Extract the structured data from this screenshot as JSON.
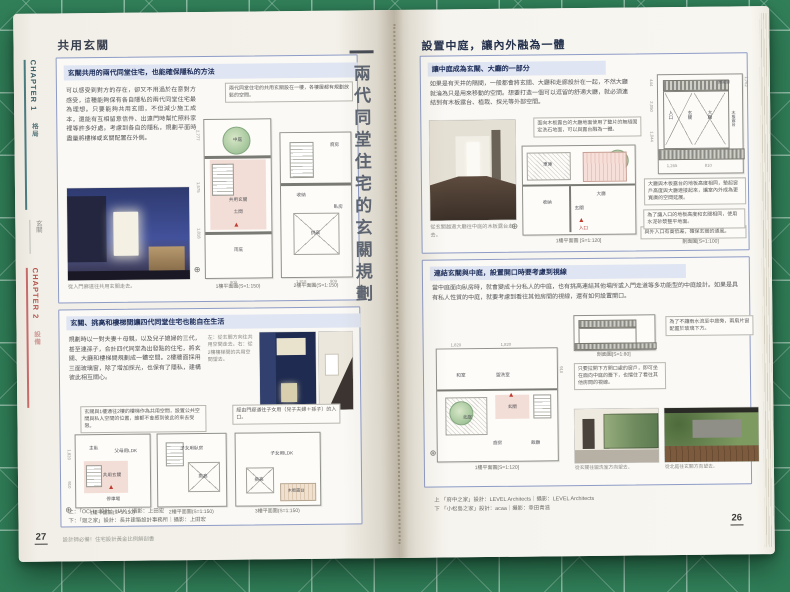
{
  "icons": {
    "compass": "⊕"
  },
  "spine": {
    "title": "兩代同堂住宅的玄關規劃"
  },
  "left_page": {
    "tabs": {
      "chapter1": "CHAPTER 1",
      "chapter1_topic": "格局",
      "chapter1_sub": "玄關",
      "chapter2": "CHAPTER 2",
      "chapter2_topic": "設備"
    },
    "header": "共用玄關",
    "section1": {
      "title": "玄關共用的兩代同堂住宅，也能確保隱私的方法",
      "body": "可以感受到對方的存在，卻又不用過於在意對方感受，這種能夠保有各自隱私的兩代同堂住宅最為理想。只要能夠共用玄關，不但減少施工成本，還能有互相留意信件、出遠門時幫忙照料家裡等許多好處。考慮到各自的隱私，規劃平面時盡量將樓梯或玄關配置在外側。",
      "callout": "兩代同堂住宅的共用玄關設在一樓，各樓層都有規劃放鬆的空間。",
      "photo_caption": "從入門廊道往共用玄關走去。",
      "plan1": {
        "label": "1樓平面圖(S=1:150)",
        "rooms": [
          "中庭",
          "共用玄關",
          "土間",
          "雨庇"
        ],
        "dims": [
          "2,777",
          "1,575",
          "1,818",
          "909"
        ]
      },
      "plan2": {
        "label": "2樓平面圖(S=1:150)",
        "rooms": [
          "廚房",
          "收納",
          "挑高",
          "臥房"
        ],
        "dims": [
          "1,818",
          "909"
        ]
      }
    },
    "section2": {
      "title": "玄關、挑高和樓梯間讓四代同堂住宅也能自在生活",
      "body": "規劃時以一對夫妻＋母親，以及兒子媳婦的三代，甚至連孫子，合計四代同堂為出發點的住宅，將玄關、大廳和樓梯間規劃成一體空間。2樓牆面採用三面玻璃窗，除了增加採光，也保有了隱私，建構彼此相互關心。",
      "caption": "左：從玄關方向往共用空間走去。右：從2樓樓梯間的共用空間望去。",
      "callout1": "玄關與1樓通往2樓的樓梯作為共用空間，設置公共空間與私人空間的位置，誰都不會感到彼此的來去受限。",
      "callout2": "經由門廊通往子女用（兒子夫婦＋孫子）的入口。",
      "plan1": {
        "label": "1樓平面圖(S=1:150)",
        "rooms": [
          "共用玄關",
          "主臥",
          "父母用LDK",
          "停車場"
        ],
        "dims": [
          "1,820",
          "910"
        ]
      },
      "plan2": {
        "label": "2樓平面圖(S=1:150)",
        "rooms": [
          "子女用臥房",
          "挑高"
        ]
      },
      "plan3": {
        "label": "3樓平面圖(S=1:150)",
        "rooms": [
          "子女用LDK",
          "挑高",
          "木板露台"
        ]
      }
    },
    "credits": [
      "上：「OCH」設計：HAK｜攝影：上田宏",
      "下：「廻之家」設計：長井建築設計事務所｜攝影：上田宏"
    ],
    "footer": {
      "page_number": "27",
      "book_title": "設計師必備！住宅設計黃金比例解剖書"
    }
  },
  "right_page": {
    "header": "設置中庭，讓內外融為一體",
    "section1": {
      "title": "讓中庭成為玄關、大廳的一部分",
      "body": "如果是有天井的隔間，一般都會將玄關、大廳和走廊設計在一起，不然大廳就淪為只是用來移動的空間。想要打造一個可以逗留的舒適大廳，就必須連結到有木板露台、植栽、採光等外部空間。",
      "plan_callout": "面向木板露台的大廳地面使用了整片的無縫固定洗石地面，可以與露台融為一體。",
      "photo_caption": "從玄關越過大廳往中庭的木板露台走去。",
      "plan": {
        "label": "1樓平面圖 [S=1:120]",
        "rooms": [
          "車庫",
          "大廳",
          "收納",
          "玄關",
          "入口"
        ]
      },
      "plan_note": "與外入口有高低差，確保玄關的通風。",
      "section_drawing": {
        "label": "剖面圖[S=1:100]",
        "rooms": [
          "入口",
          "玄關",
          "大廳",
          "木板露台",
          "固定窗"
        ],
        "dims": [
          "1,762",
          "444",
          "2,050",
          "1,044",
          "1,265",
          "810"
        ]
      },
      "section_callout1": "大廳與木板露台的地板高度相同，墊起窗戶高度與大廳連接起來，讓室內外成為更寬廣的空間延展。",
      "section_callout2": "為了讓入口的地板高度和玄關相同，使用水泥砂漿整平地面。"
    },
    "section2": {
      "title": "連結玄關與中庭，設置開口時要考慮到視線",
      "body": "當中庭面向臥房時，就會變成十分私人的中庭，也有挑高連結其他場所或入門走道等多功能型的中庭設計。如果是具有私人性質的中庭，就要考慮到看往其他房間的視線，還有如何設置開口。",
      "callout1": "為了不讓雨水流至中庭旁，兩扇片窗配置於玻璃下方。",
      "callout2": "只要拉開下方開口處的窗戶，即可坐在面向中庭的簷下，也擋住了看往其他房間的視線。",
      "plan": {
        "label": "1樓平面圖[S=1:120]",
        "rooms": [
          "和室",
          "盥洗室",
          "玄關",
          "北庭",
          "廚房",
          "飯廳"
        ],
        "dims": [
          "1,820",
          "1,820",
          "910"
        ]
      },
      "section_label": "剖面圖[S=1:80]",
      "photo_caption1": "從玄關往盥洗室方向望去。",
      "photo_caption2": "從北庭往玄關方向望去。"
    },
    "credits": [
      "上 「府中之家」設計：LEVEL Architects｜攝影：LEVEL Architects",
      "下 「小松島之家」設計：acaa｜攝影：幸田青滋"
    ],
    "page_number": "26"
  }
}
